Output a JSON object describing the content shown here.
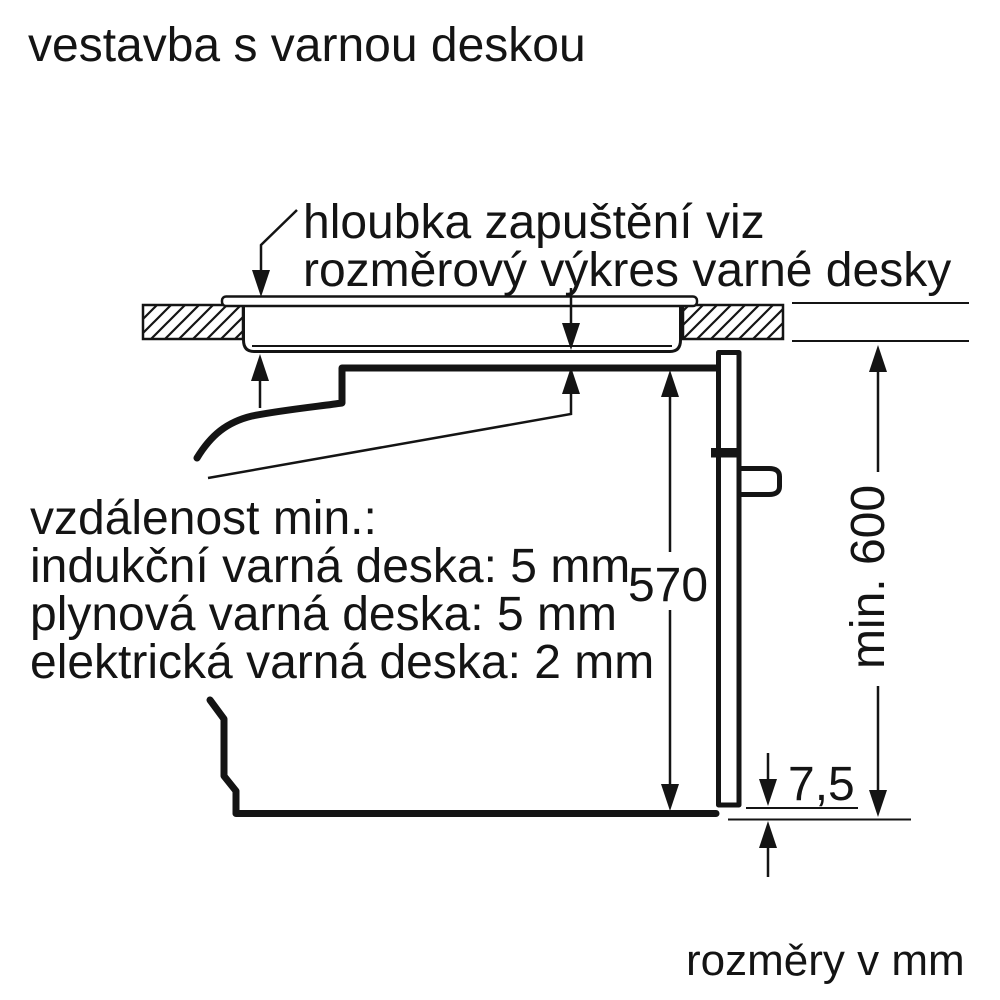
{
  "title": "vestavba s varnou deskou",
  "callout": {
    "line1": "hloubka zapuštění viz",
    "line2": "rozměrový výkres varné desky"
  },
  "notes": {
    "heading": "vzdálenost min.:",
    "induction": "indukční varná deska: 5 mm",
    "gas": "plynová varná deska: 5 mm",
    "electric": "elektrická varná deska: 2 mm"
  },
  "dimensions": {
    "oven_height_mm": "570",
    "niche_height_mm": "min. 600",
    "door_bottom_gap_mm": "7,5"
  },
  "footer": "rozměry v mm",
  "colors": {
    "ink": "#141414",
    "background": "#ffffff"
  }
}
